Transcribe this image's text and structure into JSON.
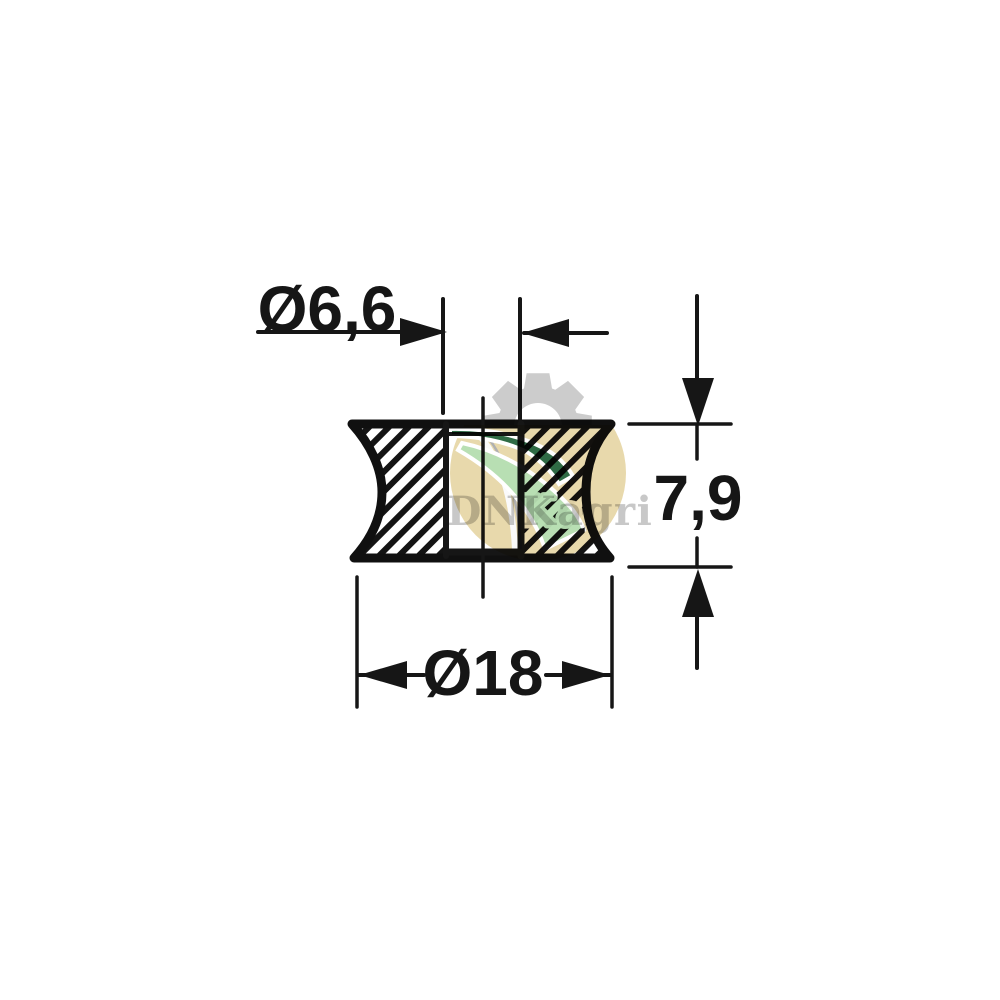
{
  "drawing": {
    "line_color": "#161616",
    "labels": {
      "bore_diameter": "Ø6,6",
      "height": "7,9",
      "outer_diameter": "Ø18"
    }
  },
  "watermark": {
    "text": "DNKagri",
    "colors": {
      "gear": "#cccccc",
      "field": "#e8d9ac",
      "swoosh_light": "#b8dfb3",
      "swoosh_dark": "#2f6b45",
      "text": "#c6c6c6"
    }
  }
}
